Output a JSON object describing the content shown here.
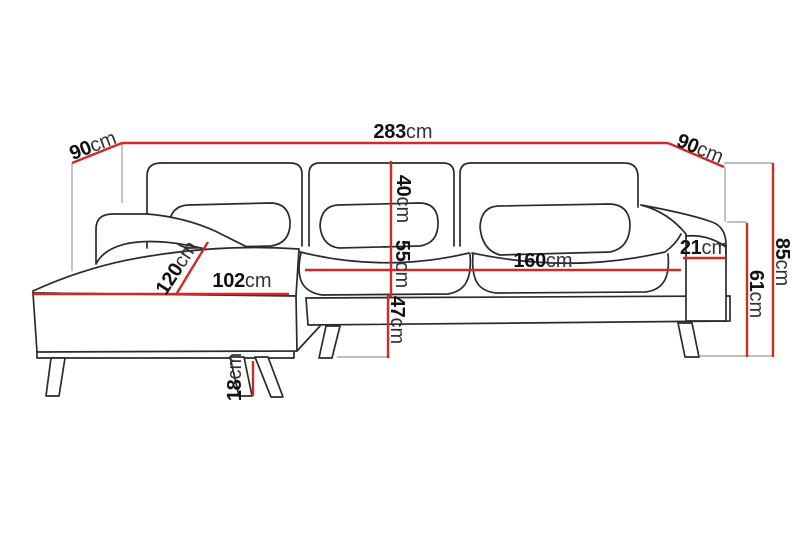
{
  "diagram_type": "sofa-dimension-drawing",
  "colors": {
    "dimension_line": "#cf2a26",
    "extent_line": "#ababab",
    "outline": "#2b2b2b",
    "background": "#ffffff",
    "number_text": "#111111",
    "unit_text": "#333333"
  },
  "measurements": {
    "total_width": {
      "value": "283",
      "unit": "cm"
    },
    "left_depth": {
      "value": "90",
      "unit": "cm"
    },
    "right_depth": {
      "value": "90",
      "unit": "cm"
    },
    "back_height": {
      "value": "40",
      "unit": "cm"
    },
    "seat_mid_height": {
      "value": "55",
      "unit": "cm"
    },
    "seat_height": {
      "value": "47",
      "unit": "cm"
    },
    "chaise_depth": {
      "value": "120",
      "unit": "cm"
    },
    "chaise_width": {
      "value": "102",
      "unit": "cm"
    },
    "seat_width": {
      "value": "160",
      "unit": "cm"
    },
    "armrest_width": {
      "value": "21",
      "unit": "cm"
    },
    "armrest_height": {
      "value": "61",
      "unit": "cm"
    },
    "total_height": {
      "value": "85",
      "unit": "cm"
    },
    "leg_height": {
      "value": "18",
      "unit": "cm"
    }
  }
}
